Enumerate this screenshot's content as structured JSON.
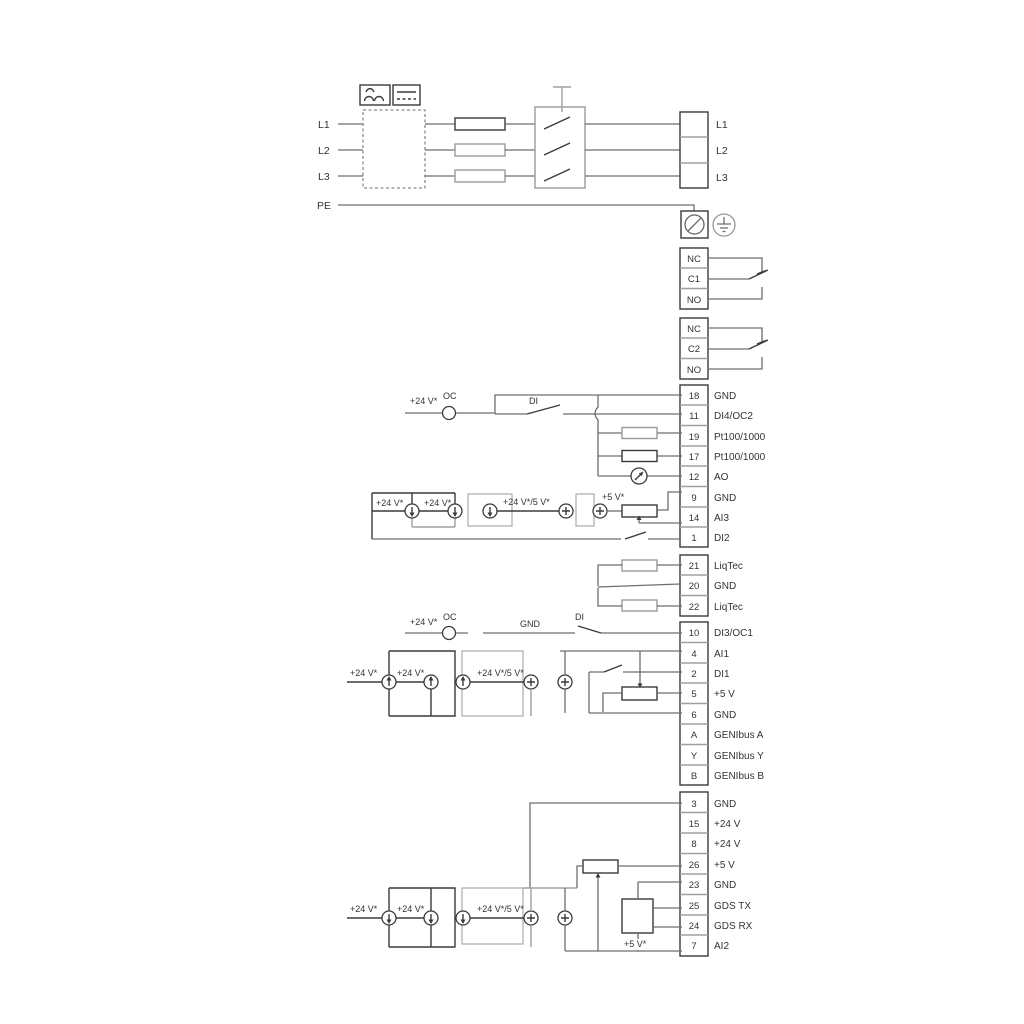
{
  "accent_colors": {
    "wire_gray": "#9a9a9a",
    "wire_dark": "#3a3a3a",
    "text": "#333333"
  },
  "power": {
    "inputs": [
      "L1",
      "L2",
      "L3",
      "PE"
    ],
    "outputs": [
      "L1",
      "L2",
      "L3"
    ]
  },
  "relay1": {
    "rows": [
      "NC",
      "C1",
      "NO"
    ]
  },
  "relay2": {
    "rows": [
      "NC",
      "C2",
      "NO"
    ]
  },
  "tb_io": {
    "rows": [
      {
        "num": "18",
        "label": "GND"
      },
      {
        "num": "11",
        "label": "DI4/OC2"
      },
      {
        "num": "19",
        "label": "Pt100/1000"
      },
      {
        "num": "17",
        "label": "Pt100/1000"
      },
      {
        "num": "12",
        "label": "AO"
      },
      {
        "num": "9",
        "label": "GND"
      },
      {
        "num": "14",
        "label": "AI3"
      },
      {
        "num": "1",
        "label": "DI2"
      }
    ]
  },
  "tb_liqtec": {
    "rows": [
      {
        "num": "21",
        "label": "LiqTec"
      },
      {
        "num": "20",
        "label": "GND"
      },
      {
        "num": "22",
        "label": "LiqTec"
      }
    ]
  },
  "tb_comm": {
    "rows": [
      {
        "num": "10",
        "label": "DI3/OC1"
      },
      {
        "num": "4",
        "label": "AI1"
      },
      {
        "num": "2",
        "label": "DI1"
      },
      {
        "num": "5",
        "label": "+5 V"
      },
      {
        "num": "6",
        "label": "GND"
      },
      {
        "num": "A",
        "label": "GENIbus A"
      },
      {
        "num": "Y",
        "label": "GENIbus Y"
      },
      {
        "num": "B",
        "label": "GENIbus B"
      }
    ]
  },
  "tb_power": {
    "rows": [
      {
        "num": "3",
        "label": "GND"
      },
      {
        "num": "15",
        "label": "+24 V"
      },
      {
        "num": "8",
        "label": "+24 V"
      },
      {
        "num": "26",
        "label": "+5 V"
      },
      {
        "num": "23",
        "label": "GND"
      },
      {
        "num": "25",
        "label": "GDS TX"
      },
      {
        "num": "24",
        "label": "GDS RX"
      },
      {
        "num": "7",
        "label": "AI2"
      }
    ]
  },
  "ann": {
    "oc_row1": {
      "v24": "+24 V*",
      "oc": "OC",
      "di": "DI"
    },
    "ai3": {
      "l1": "+24 V*",
      "l2": "+24 V*",
      "l3": "+24 V*/5 V*",
      "l4": "+5 V*"
    },
    "oc_row2": {
      "v24": "+24 V*",
      "oc": "OC",
      "gnd": "GND",
      "di": "DI"
    },
    "ai1": {
      "l1": "+24 V*",
      "l2": "+24 V*",
      "l3": "+24 V*/5 V*"
    },
    "ai2": {
      "l1": "+24 V*",
      "l2": "+24 V*",
      "l3": "+24 V*/5 V*",
      "l4": "+5 V*"
    }
  }
}
